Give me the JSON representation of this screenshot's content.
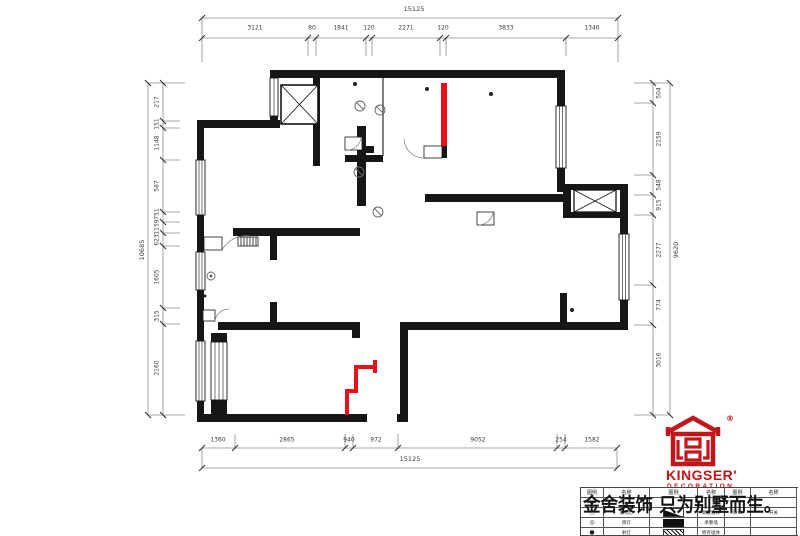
{
  "dims": {
    "top": {
      "total": "15125",
      "segments": [
        "3121",
        "80",
        "1841",
        "120",
        "2271",
        "120",
        "3833",
        "1346"
      ]
    },
    "bottom": {
      "total": "15125",
      "segments": [
        "1360",
        "2865",
        "940",
        "972",
        "9052",
        "254",
        "1582"
      ]
    },
    "left": {
      "total": "10685",
      "segments": [
        "217",
        "151",
        "1148",
        "587",
        "751",
        "1159",
        "623",
        "1605",
        "315",
        "2160"
      ]
    },
    "right": {
      "total": "9620",
      "segments": [
        "504",
        "2159",
        "548",
        "915",
        "2277",
        "774",
        "3016"
      ]
    }
  },
  "logo": {
    "brand": "KINGSER'",
    "subtitle": "DECORATION",
    "registered": "®",
    "color": "#c2161b"
  },
  "watermark": "金舍装饰 只为别墅而生。",
  "legend": {
    "headers": [
      "图例",
      "名称",
      "图例",
      "名称",
      "图例",
      "名称"
    ],
    "rows": [
      [
        "◆",
        "",
        "",
        "",
        "",
        ""
      ],
      [
        "○",
        "吸顶灯",
        "",
        "新建墙体",
        "⊙⊛",
        "开关"
      ],
      [
        "◎",
        "筒灯",
        "",
        "承重墙",
        "",
        ""
      ],
      [
        "●",
        "射灯",
        "",
        "原有墙体",
        "",
        ""
      ]
    ]
  },
  "plan": {
    "wall_color": "#161616",
    "highlight_color": "#e8111a"
  }
}
